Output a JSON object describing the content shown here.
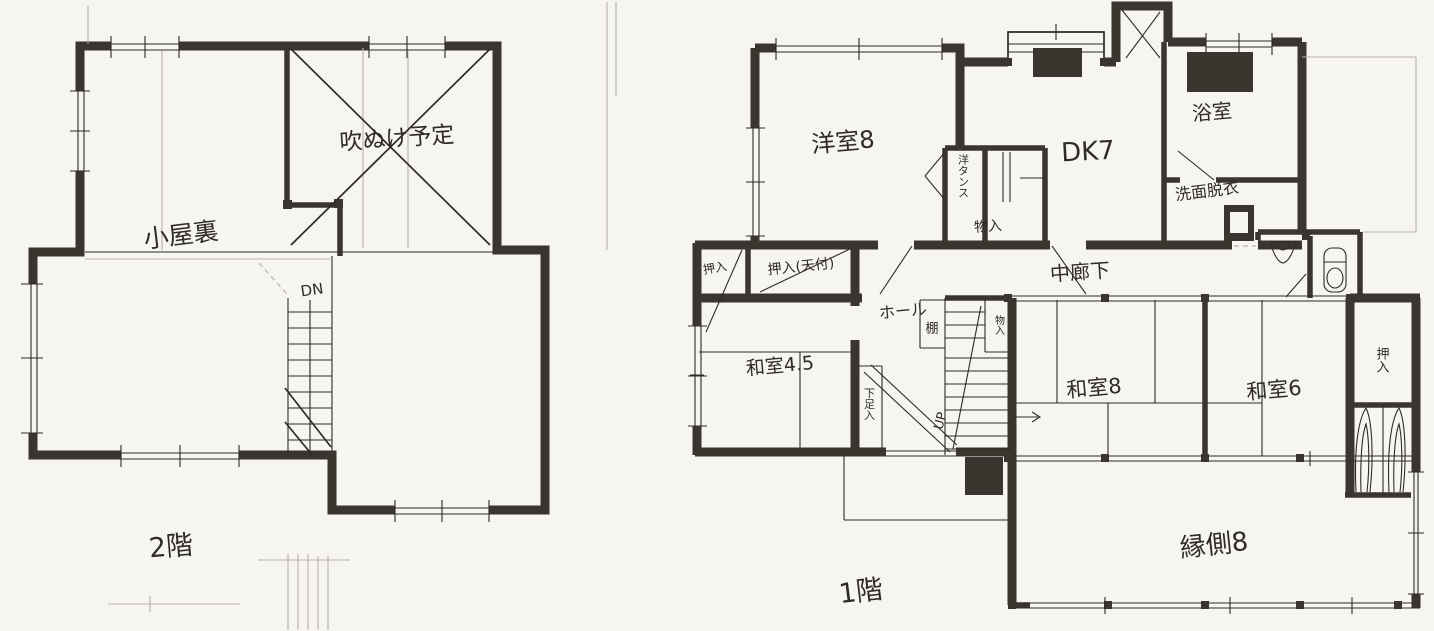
{
  "colors": {
    "paper": "#f6f5f1",
    "ink": "#2f2b26",
    "wall": "#3a352f",
    "pencil": "#b9b2a6",
    "faint": "#d8d3c9"
  },
  "floor2": {
    "floor_label": "2階",
    "rooms": {
      "attic": "小屋裏",
      "open_void": "吹ぬけ予定"
    },
    "stairs": {
      "direction": "DN"
    }
  },
  "floor1": {
    "floor_label": "1階",
    "rooms": {
      "western_room": "洋室8",
      "dining_kitchen": "DK7",
      "bathroom": "浴室",
      "washroom": "洗面脱衣",
      "corridor": "中廊下",
      "hall": "ホール",
      "tatami_45": "和室4.5",
      "tatami_8": "和室8",
      "tatami_6": "和室6",
      "veranda": "縁側8"
    },
    "closets": {
      "wardrobe": "洋タンス",
      "storage_north": "物入",
      "corner_closet": "押入",
      "ceiling_closet": "押入(天付)",
      "shelf": "棚",
      "stair_storage": "物入",
      "shoe_closet": "下足入",
      "east_closet": "押入"
    },
    "stairs": {
      "direction": "UP"
    }
  }
}
